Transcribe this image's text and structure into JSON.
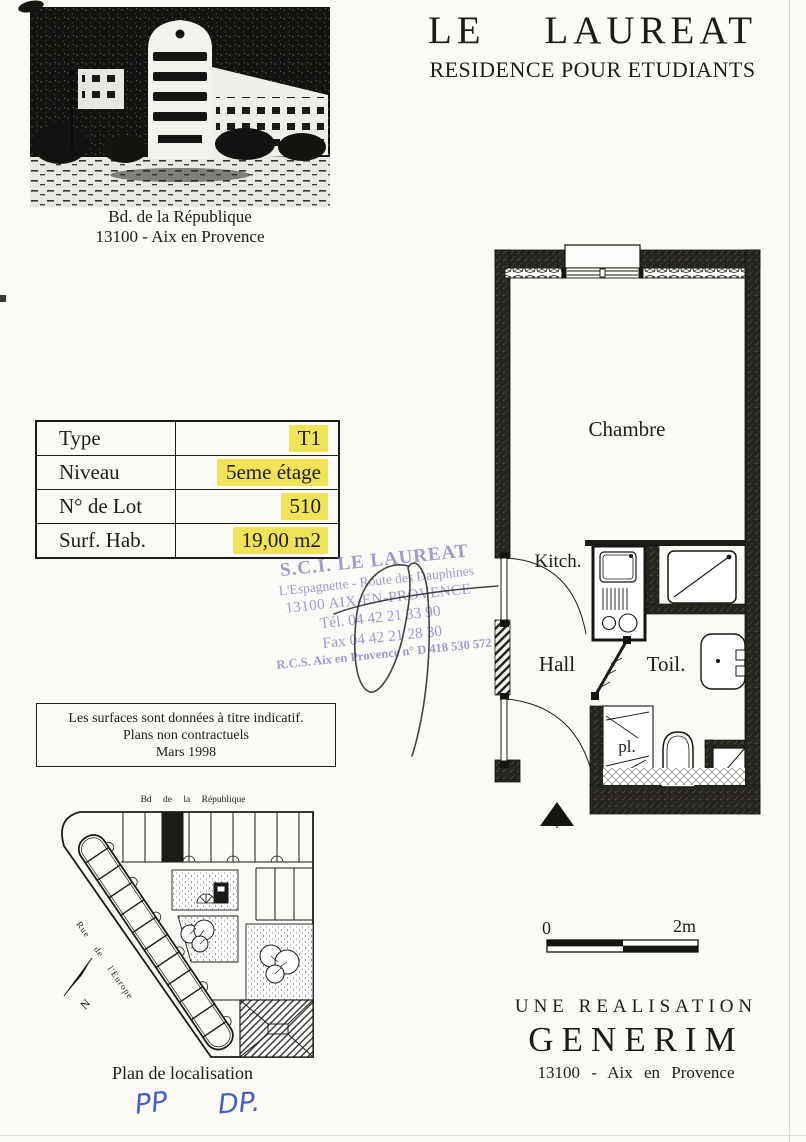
{
  "document": {
    "title": "LE LAUREAT",
    "subtitle": "RESIDENCE POUR ETUDIANTS"
  },
  "photo": {
    "caption_line1": "Bd. de la République",
    "caption_line2": "13100 - Aix en Provence"
  },
  "info_table": {
    "highlight_color": "#f2e257",
    "rows": [
      {
        "label": "Type",
        "value": "T1"
      },
      {
        "label": "Niveau",
        "value": "5eme étage"
      },
      {
        "label": "N° de Lot",
        "value": "510"
      },
      {
        "label": "Surf. Hab.",
        "value": "19,00 m2"
      }
    ]
  },
  "stamp": {
    "ink_color": "#8b87bb",
    "line1": "S.C.I. LE LAUREAT",
    "line2": "L'Espagnette - Route des Dauphines",
    "line3": "13100 AIX-EN-PROVENCE",
    "line4": "Tél. 04 42 21 33 90",
    "line5": "Fax 04 42 21 28 30",
    "line6": "R.C.S. Aix en Provence n° D 418 530 572"
  },
  "notice": {
    "line1": "Les surfaces sont données à titre indicatif.",
    "line2": "Plans non contractuels",
    "line3": "Mars 1998"
  },
  "floor_plan": {
    "room_chambre": "Chambre",
    "room_kitch": "Kitch.",
    "room_hall": "Hall",
    "room_toil": "Toil.",
    "room_pl": "pl."
  },
  "location_plan": {
    "street_top": "Bd de la République",
    "street_side": "Rue de l'Europe",
    "north": "N",
    "caption": "Plan de localisation"
  },
  "scale_bar": {
    "label_start": "0",
    "label_end": "2m"
  },
  "developer": {
    "line1": "UNE REALISATION",
    "line2": "GENERIM",
    "line3": "13100 - Aix en Provence"
  },
  "handwriting": {
    "initials_1": "PP",
    "initials_2": "DP.",
    "ink_color": "#4a5fc0"
  }
}
